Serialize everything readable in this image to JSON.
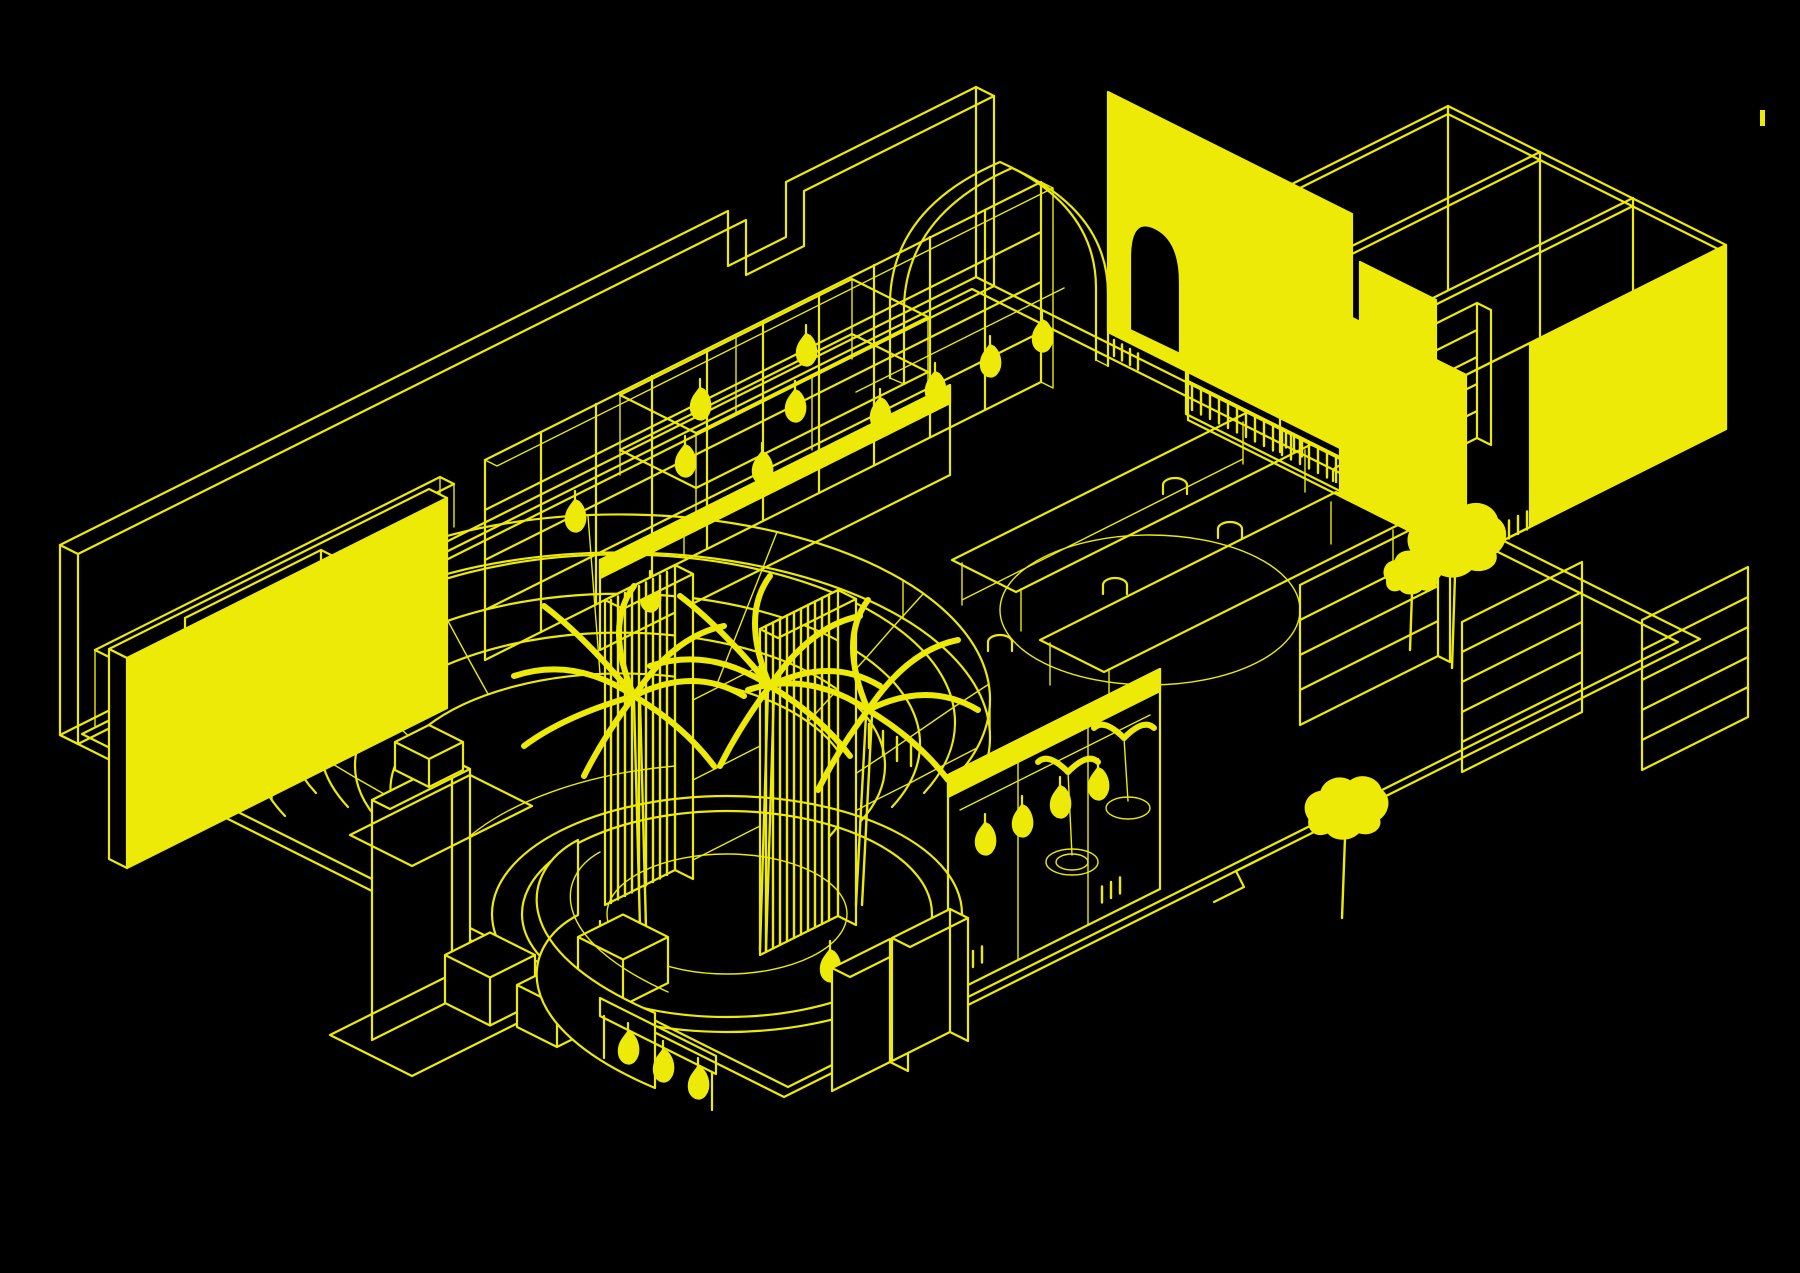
{
  "app": {
    "name": "cad-axonometric-viewport",
    "description": "Axonometric wireframe CAD drawing of a retail interior floor plan, bright yellow line art on a black background"
  },
  "colors": {
    "background": "#000000",
    "line": "#ecea06"
  },
  "cursor_mark": {
    "x": 1760,
    "y": 110,
    "width": 5,
    "height": 16
  },
  "scene": {
    "style": "isometric line drawing",
    "elements": [
      {
        "id": 0,
        "label": "floor plate with double border walkway"
      },
      {
        "id": 1,
        "label": "long back perimeter wall with doorway notch"
      },
      {
        "id": 2,
        "label": "low parapet wall in front of back wall"
      },
      {
        "id": 3,
        "label": "solid display wall panel"
      },
      {
        "id": 4,
        "label": "curved tiered amphitheater shelving"
      },
      {
        "id": 5,
        "label": "long open grid shelving wall"
      },
      {
        "id": 6,
        "label": "double deck wall shelf bridge"
      },
      {
        "id": 7,
        "label": "wireframe arched opening"
      },
      {
        "id": 8,
        "label": "solid wall panel with arched doorway"
      },
      {
        "id": 9,
        "label": "side wall panel"
      },
      {
        "id": 10,
        "label": "wireframe room enclosures at right"
      },
      {
        "id": 11,
        "label": "book spine shelf bands"
      },
      {
        "id": 12,
        "label": "wall mounted bookcase"
      },
      {
        "id": 13,
        "label": "low partition wall with lit top"
      },
      {
        "id": 14,
        "label": "tall shelf tower left"
      },
      {
        "id": 15,
        "label": "tall shelf tower right"
      },
      {
        "id": 16,
        "label": "long reading table left"
      },
      {
        "id": 17,
        "label": "long reading table right"
      },
      {
        "id": 18,
        "label": "circular floor inlay"
      },
      {
        "id": 19,
        "label": "chairs"
      },
      {
        "id": 20,
        "label": "indoor trees"
      },
      {
        "id": 21,
        "label": "garment display partition"
      },
      {
        "id": 22,
        "label": "open bookcase a"
      },
      {
        "id": 23,
        "label": "open bookcase b"
      },
      {
        "id": 24,
        "label": "open bookcase c"
      },
      {
        "id": 25,
        "label": "circular planter rings"
      },
      {
        "id": 26,
        "label": "palm tree cluster"
      },
      {
        "id": 27,
        "label": "potted plants"
      },
      {
        "id": 28,
        "label": "freestanding column slab"
      },
      {
        "id": 29,
        "label": "floor display cubes"
      },
      {
        "id": 30,
        "label": "curved service counter"
      },
      {
        "id": 31,
        "label": "hanging display panel"
      },
      {
        "id": 32,
        "label": "storage cabinets"
      },
      {
        "id": 33,
        "label": "low side bookshelf"
      },
      {
        "id": 34,
        "label": "display plinth"
      },
      {
        "id": 35,
        "label": "hanging plants on rail"
      },
      {
        "id": 36,
        "label": "floor edge step"
      },
      {
        "id": 37,
        "label": "stray cursor tick"
      }
    ]
  }
}
